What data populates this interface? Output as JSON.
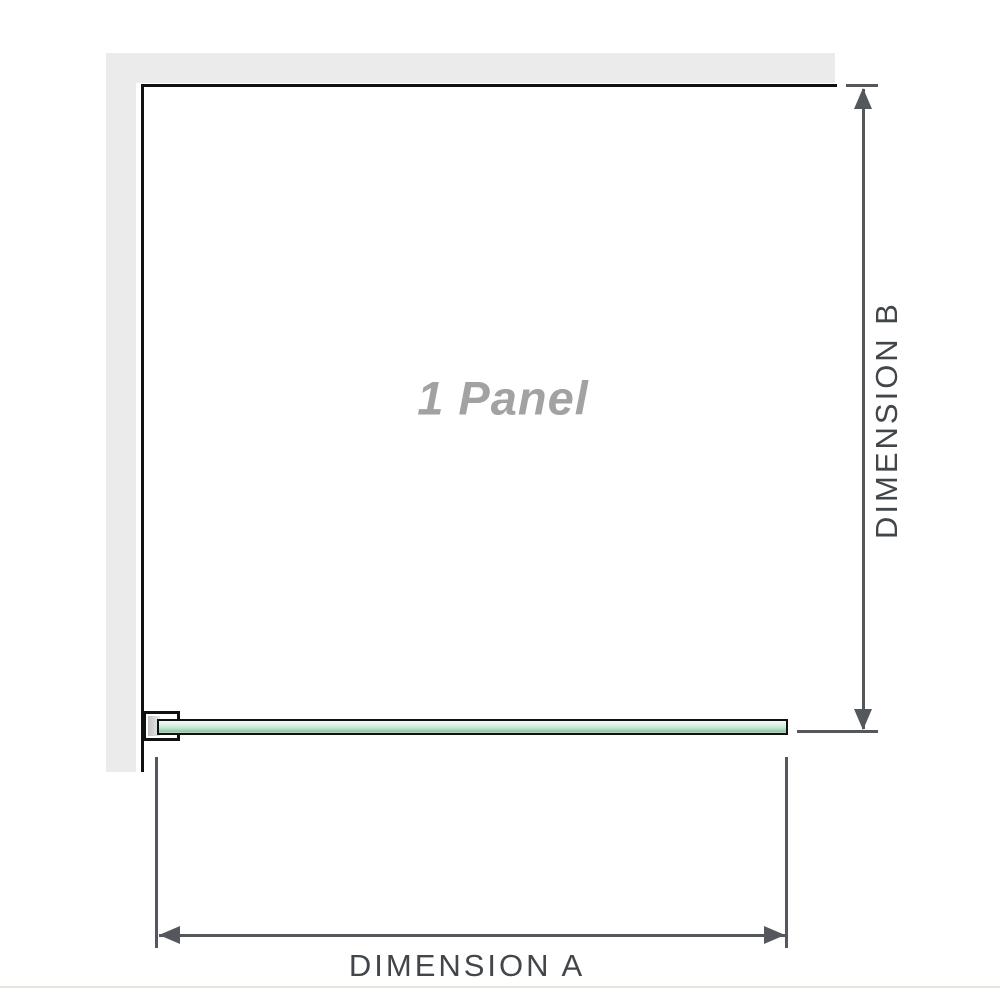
{
  "diagram": {
    "panel_label": "1 Panel",
    "dimension_a_label": "DIMENSION A",
    "dimension_b_label": "DIMENSION B"
  },
  "colors": {
    "wall": "#ebebeb",
    "frame-line": "#111111",
    "dim-line": "#54585c",
    "dim-text": "#41464b",
    "panel-text": "#a2a2a2",
    "glass-top": "#f5faf6",
    "glass-bottom": "#9cd2b2",
    "glass-border": "#111111",
    "bracket-fill": "#c3c3c3",
    "baseline-rule": "#e7e4dc"
  }
}
